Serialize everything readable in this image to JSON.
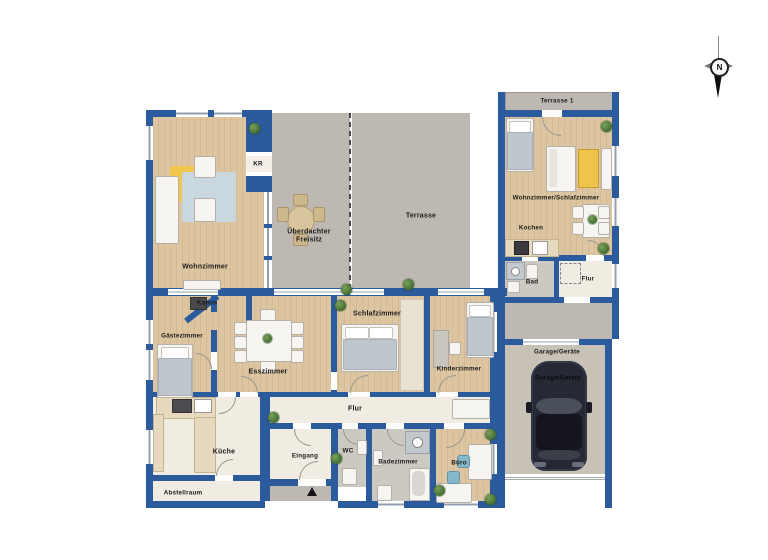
{
  "labels": {
    "wohnzimmer": "Wohnzimmer",
    "kr": "KR",
    "ueberdachter_freisitz": "Überdachter Freisitz",
    "terrasse": "Terrasse",
    "kamin": "Kamin",
    "gaestezimmer": "Gästezimmer",
    "esszimmer": "Esszimmer",
    "schlafzimmer": "Schlafzimmer",
    "kinderzimmer": "Kinderzimmer",
    "flur": "Flur",
    "kueche": "Küche",
    "abstellraum": "Abstellraum",
    "eingang": "Eingang",
    "wc": "WC",
    "badezimmer": "Badezimmer",
    "buero": "Büro"
  },
  "unit2_labels": {
    "terrasse_1": "Terrasse 1",
    "wohnzimmer_schlafzimmer": "Wohnzimmer/Schlafzimmer",
    "kochen": "Kochen",
    "bad": "Bad",
    "flur": "Flur",
    "garage": "Garage/Geräte",
    "garage_car": "Garage/Geräte"
  },
  "compass": {
    "north": "N"
  },
  "colors": {
    "wall": "#2b5b9d",
    "wood_floor": "#d8c19c",
    "terrace": "#bdb9b2",
    "floor_light": "#f0ece2",
    "floor_bath": "#ccc8c2",
    "garage_floor": "#c7c1b6",
    "accent_yellow": "#f0c34a",
    "car": "#262934",
    "plant_green": "#4e7a38"
  }
}
